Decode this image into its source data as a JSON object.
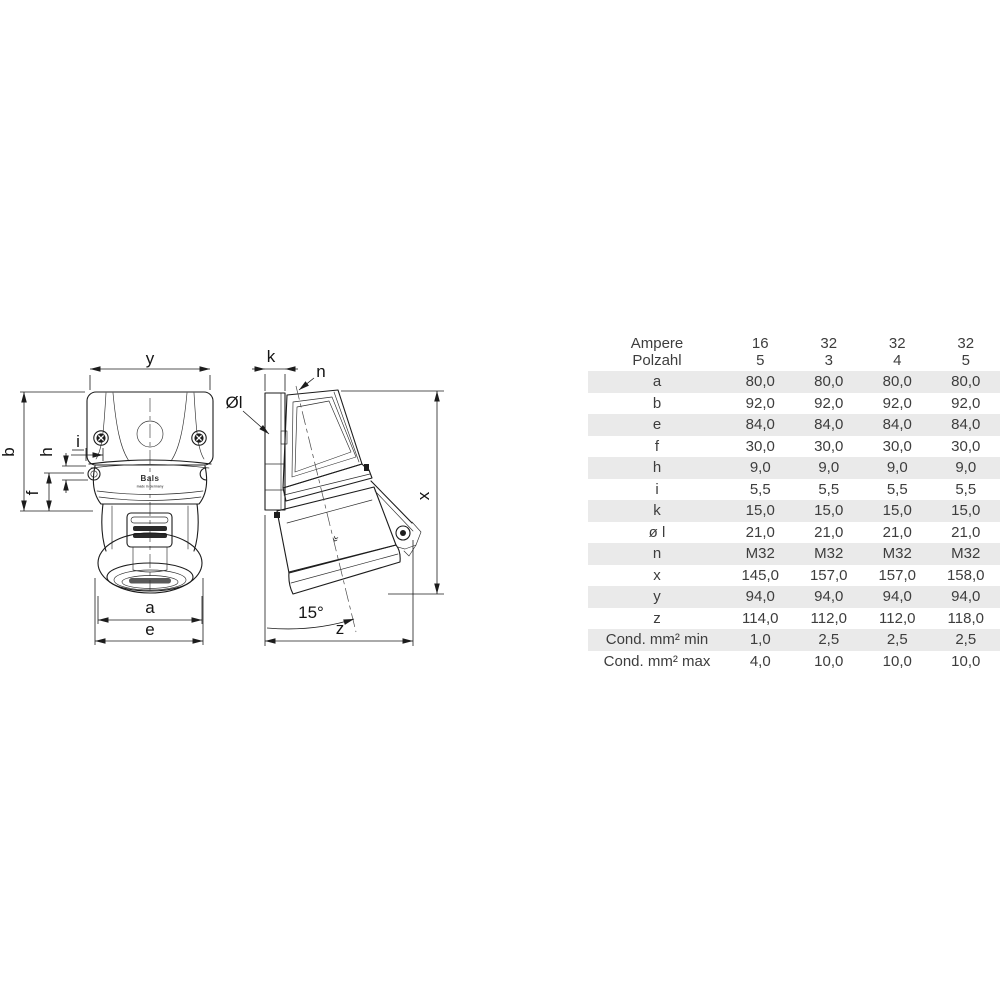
{
  "colors": {
    "background": "#ffffff",
    "table_row_shade": "#eaeaea",
    "table_text": "#3d3d3d",
    "drawing_line": "#1c1c1c"
  },
  "drawing": {
    "front_view": {
      "dim_labels": {
        "y": "y",
        "b": "b",
        "h": "h",
        "i": "i",
        "f": "f",
        "a": "a",
        "e": "e"
      },
      "logo_text": "Bals",
      "logo_subtext": "made in Germany"
    },
    "side_view": {
      "dim_labels": {
        "k": "k",
        "n": "n",
        "diameter": "Øl",
        "x": "x",
        "z": "z",
        "angle": "15°"
      }
    }
  },
  "table": {
    "header": {
      "row1_label": "Ampere",
      "row2_label": "Polzahl",
      "columns": [
        {
          "ampere": "16",
          "polzahl": "5"
        },
        {
          "ampere": "32",
          "polzahl": "3"
        },
        {
          "ampere": "32",
          "polzahl": "4"
        },
        {
          "ampere": "32",
          "polzahl": "5"
        }
      ]
    },
    "rows": [
      {
        "label": "a",
        "values": [
          "80,0",
          "80,0",
          "80,0",
          "80,0"
        ]
      },
      {
        "label": "b",
        "values": [
          "92,0",
          "92,0",
          "92,0",
          "92,0"
        ]
      },
      {
        "label": "e",
        "values": [
          "84,0",
          "84,0",
          "84,0",
          "84,0"
        ]
      },
      {
        "label": "f",
        "values": [
          "30,0",
          "30,0",
          "30,0",
          "30,0"
        ]
      },
      {
        "label": "h",
        "values": [
          "9,0",
          "9,0",
          "9,0",
          "9,0"
        ]
      },
      {
        "label": "i",
        "values": [
          "5,5",
          "5,5",
          "5,5",
          "5,5"
        ]
      },
      {
        "label": "k",
        "values": [
          "15,0",
          "15,0",
          "15,0",
          "15,0"
        ]
      },
      {
        "label": "ø l",
        "values": [
          "21,0",
          "21,0",
          "21,0",
          "21,0"
        ]
      },
      {
        "label": "n",
        "values": [
          "M32",
          "M32",
          "M32",
          "M32"
        ]
      },
      {
        "label": "x",
        "values": [
          "145,0",
          "157,0",
          "157,0",
          "158,0"
        ]
      },
      {
        "label": "y",
        "values": [
          "94,0",
          "94,0",
          "94,0",
          "94,0"
        ]
      },
      {
        "label": "z",
        "values": [
          "114,0",
          "112,0",
          "112,0",
          "118,0"
        ]
      },
      {
        "label": "Cond. mm² min",
        "values": [
          "1,0",
          "2,5",
          "2,5",
          "2,5"
        ]
      },
      {
        "label": "Cond. mm² max",
        "values": [
          "4,0",
          "10,0",
          "10,0",
          "10,0"
        ]
      }
    ]
  }
}
